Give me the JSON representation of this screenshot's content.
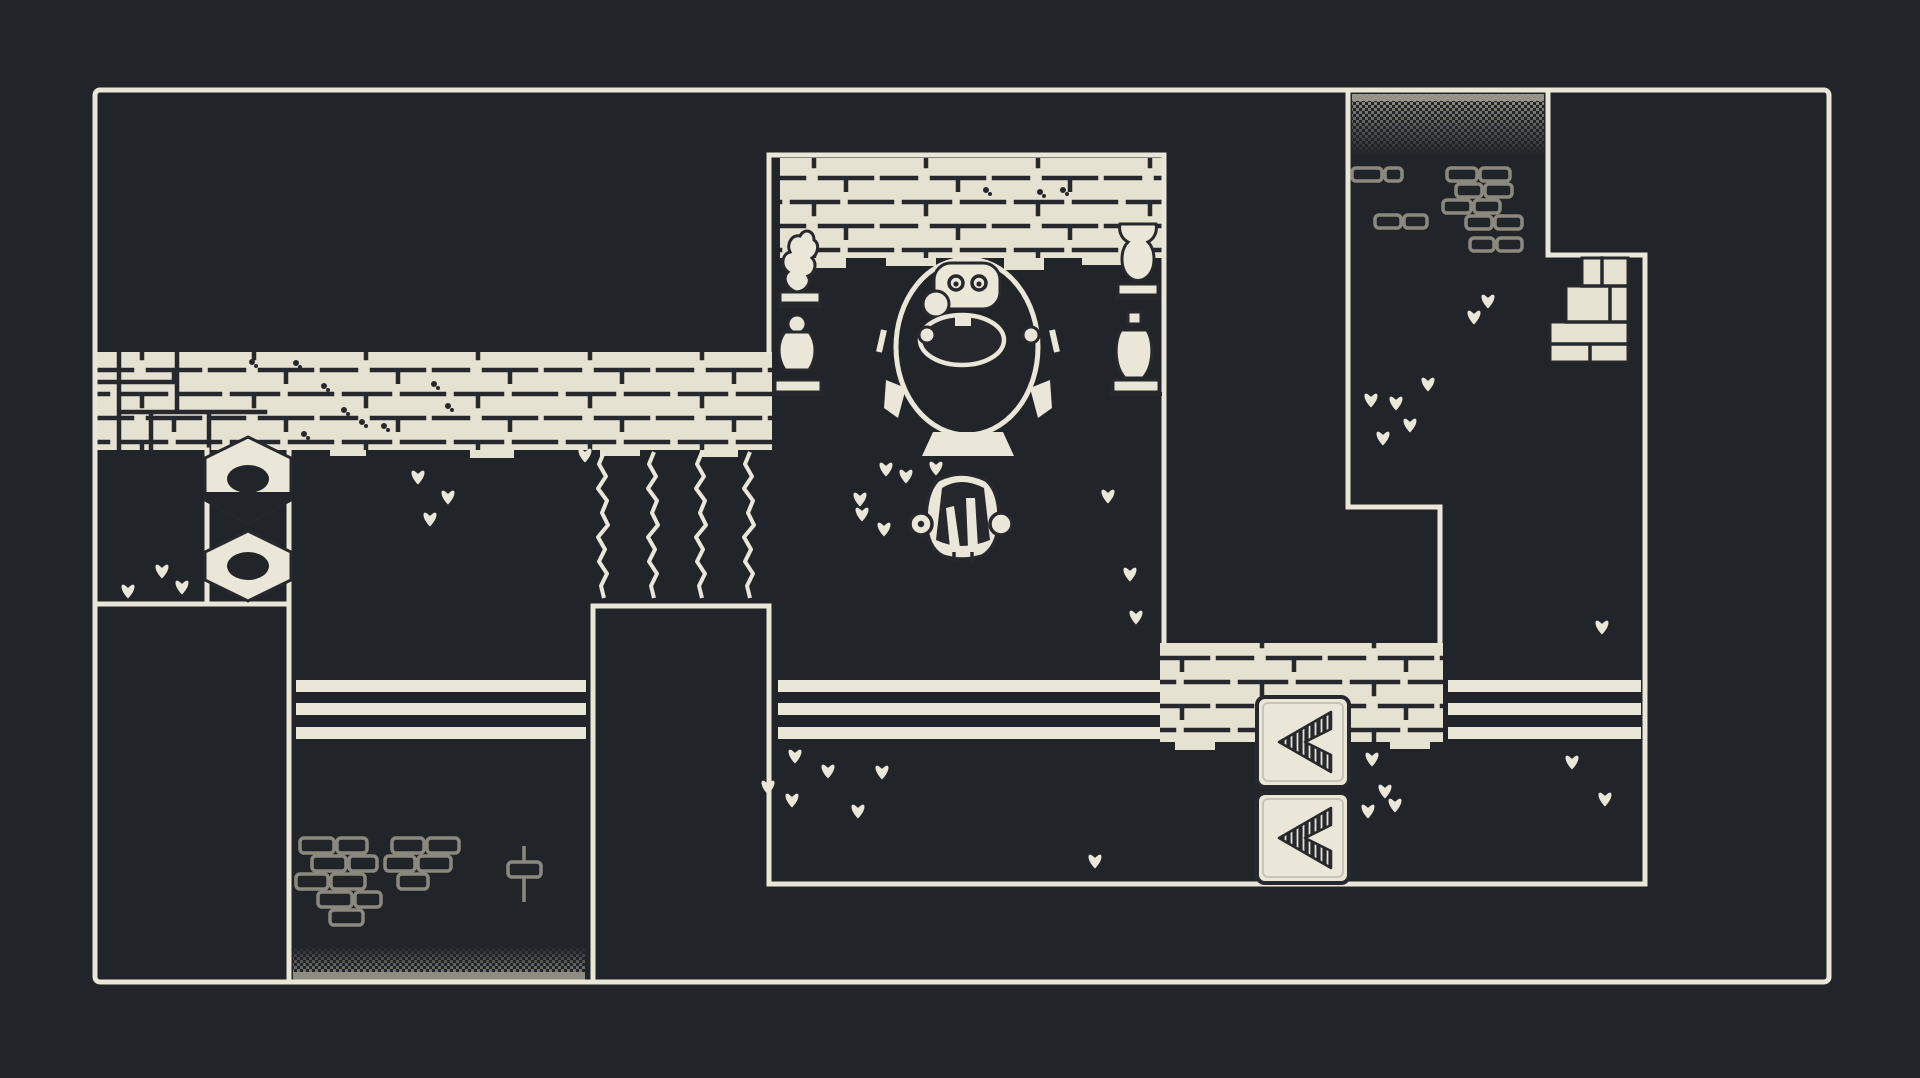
{
  "meta": {
    "scene": "monochrome top-down pixel adventure room map",
    "style": "1-bit dungeon, cream lines on dark"
  },
  "palette": {
    "bg": "#212429",
    "cream": "#eae7d8",
    "brick": "#e6e2d2",
    "joint": "#26282d",
    "decor_gray": "#8b897e",
    "dither": "#9a978b",
    "dither_solid": "#8f8d82",
    "shadow": "#16181c"
  },
  "scene": {
    "squiggles": {
      "xs": [
        604,
        654,
        702,
        750
      ],
      "y1": 452,
      "y2": 598
    },
    "bridge_ys": [
      680,
      703,
      727
    ],
    "bridge_h": 12,
    "bridges": [
      {
        "x1": 296,
        "x2": 586
      },
      {
        "x1": 778,
        "x2": 1160
      },
      {
        "x1": 1448,
        "x2": 1641
      }
    ],
    "arrow_tiles": [
      {
        "x": 1257,
        "y": 697
      },
      {
        "x": 1257,
        "y": 793
      }
    ],
    "arrow_tile_size": [
      92,
      90
    ],
    "nut_x": {
      "cx": 248,
      "x1": 205,
      "x2": 291
    },
    "nuts": [
      {
        "t": 437,
        "a": 458,
        "b": 500,
        "btm": 523,
        "hole": 479,
        "shadow": true
      },
      {
        "t": 531,
        "a": 552,
        "b": 580,
        "btm": 601,
        "hole": 566,
        "shadow": false
      }
    ],
    "clovers": [
      [
        128,
        592
      ],
      [
        162,
        572
      ],
      [
        182,
        588
      ],
      [
        418,
        478
      ],
      [
        448,
        498
      ],
      [
        430,
        520
      ],
      [
        585,
        456
      ],
      [
        886,
        470
      ],
      [
        936,
        469
      ],
      [
        906,
        477
      ],
      [
        860,
        500
      ],
      [
        884,
        530
      ],
      [
        862,
        515
      ],
      [
        795,
        757
      ],
      [
        828,
        772
      ],
      [
        768,
        788
      ],
      [
        792,
        801
      ],
      [
        858,
        812
      ],
      [
        882,
        773
      ],
      [
        1108,
        497
      ],
      [
        1130,
        575
      ],
      [
        1136,
        618
      ],
      [
        1095,
        862
      ],
      [
        1488,
        302
      ],
      [
        1474,
        318
      ],
      [
        1428,
        385
      ],
      [
        1396,
        404
      ],
      [
        1371,
        401
      ],
      [
        1410,
        426
      ],
      [
        1383,
        439
      ],
      [
        1602,
        628
      ],
      [
        1572,
        763
      ],
      [
        1605,
        800
      ],
      [
        1372,
        760
      ],
      [
        1385,
        792
      ],
      [
        1368,
        812
      ],
      [
        1395,
        806
      ]
    ],
    "moss": [
      [
        252,
        362
      ],
      [
        296,
        363
      ],
      [
        324,
        386
      ],
      [
        344,
        410
      ],
      [
        362,
        422
      ],
      [
        384,
        426
      ],
      [
        434,
        384
      ],
      [
        448,
        406
      ],
      [
        304,
        434
      ],
      [
        986,
        190
      ],
      [
        1040,
        192
      ],
      [
        1063,
        190
      ]
    ],
    "rubble_bottom_left": [
      [
        300,
        838,
        34,
        15
      ],
      [
        337,
        838,
        30,
        15
      ],
      [
        312,
        856,
        34,
        15
      ],
      [
        349,
        856,
        28,
        15
      ],
      [
        296,
        874,
        32,
        15
      ],
      [
        331,
        874,
        34,
        15
      ],
      [
        318,
        892,
        34,
        15
      ],
      [
        355,
        892,
        26,
        15
      ],
      [
        330,
        910,
        33,
        15
      ],
      [
        392,
        838,
        32,
        15
      ],
      [
        427,
        838,
        32,
        15
      ],
      [
        385,
        856,
        30,
        15
      ],
      [
        418,
        856,
        33,
        15
      ],
      [
        398,
        874,
        30,
        15
      ]
    ],
    "rubble_top_right": [
      [
        1352,
        168,
        30,
        13
      ],
      [
        1385,
        168,
        17,
        13
      ],
      [
        1447,
        168,
        30,
        13
      ],
      [
        1480,
        168,
        30,
        13
      ],
      [
        1456,
        184,
        26,
        13
      ],
      [
        1485,
        184,
        27,
        13
      ],
      [
        1443,
        200,
        28,
        13
      ],
      [
        1474,
        200,
        26,
        13
      ],
      [
        1466,
        216,
        26,
        13
      ],
      [
        1495,
        216,
        27,
        13
      ],
      [
        1375,
        215,
        26,
        13
      ],
      [
        1404,
        215,
        23,
        13
      ],
      [
        1470,
        238,
        24,
        13
      ],
      [
        1497,
        238,
        25,
        13
      ]
    ],
    "teeth_left_band": [
      [
        230,
        450,
        42,
        7
      ],
      [
        330,
        450,
        36,
        6
      ],
      [
        470,
        450,
        44,
        8
      ],
      [
        600,
        450,
        40,
        6
      ],
      [
        700,
        450,
        38,
        7
      ]
    ],
    "teeth_lintel": [
      [
        800,
        258,
        46,
        10
      ],
      [
        886,
        258,
        50,
        8
      ],
      [
        1004,
        258,
        40,
        12
      ],
      [
        1082,
        258,
        44,
        7
      ]
    ],
    "teeth_platform": [
      [
        1175,
        742,
        40,
        8
      ],
      [
        1300,
        742,
        45,
        12
      ],
      [
        1390,
        742,
        40,
        7
      ]
    ],
    "entities": [
      {
        "name": "egg-shrine",
        "desc": "oval shrine with hatching creature",
        "x": 967,
        "y": 347
      },
      {
        "name": "player-character",
        "desc": "round creature seen from behind, arms out",
        "x": 961,
        "y": 520
      },
      {
        "name": "hex-nut-top",
        "desc": "hexagonal nut boulder",
        "x": 248,
        "y": 479
      },
      {
        "name": "hex-nut-bottom",
        "desc": "hexagonal nut boulder",
        "x": 248,
        "y": 566
      },
      {
        "name": "arrow-tile-top",
        "icon": "chevron-left-icon",
        "x": 1303,
        "y": 742
      },
      {
        "name": "arrow-tile-bottom",
        "icon": "chevron-left-icon",
        "x": 1303,
        "y": 838
      },
      {
        "name": "torch-left",
        "x": 800,
        "y": 260
      },
      {
        "name": "torch-right",
        "x": 1138,
        "y": 260
      },
      {
        "name": "statue-left",
        "x": 798,
        "y": 350
      },
      {
        "name": "statue-right",
        "x": 1135,
        "y": 350
      },
      {
        "name": "stair-bricks",
        "x": 1589,
        "y": 310
      }
    ]
  }
}
